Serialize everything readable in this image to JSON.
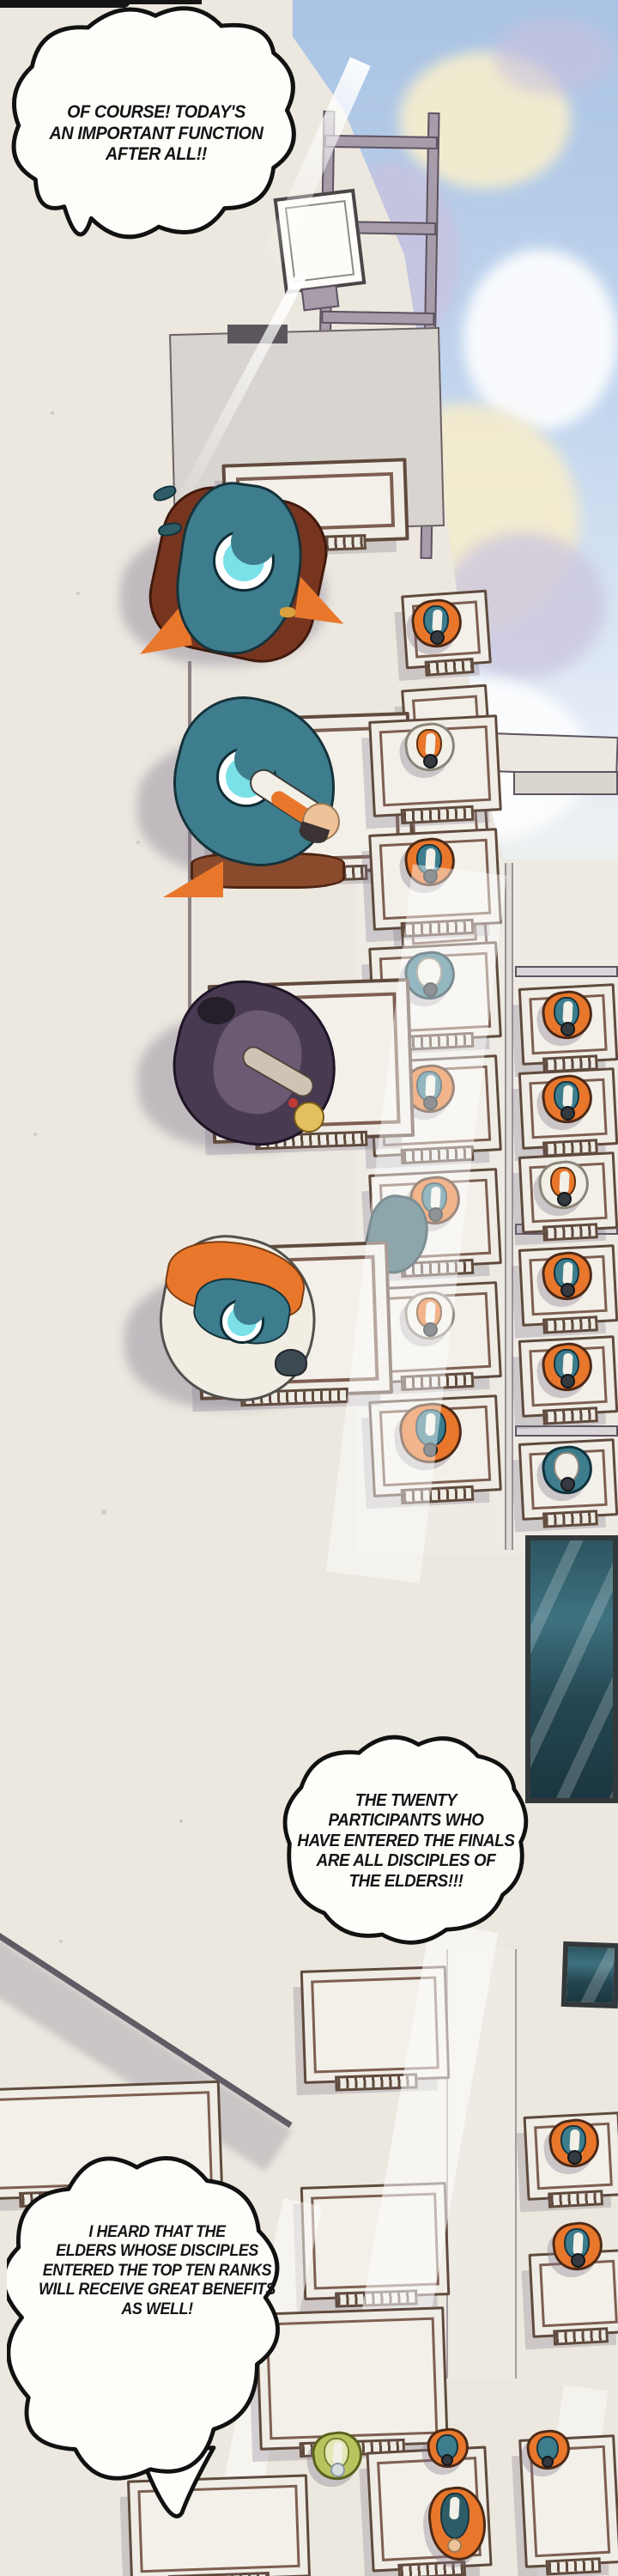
{
  "bubbles": [
    {
      "name": "shout-bubble-top-left",
      "lines": [
        "OF COURSE! TODAY'S",
        "AN IMPORTANT FUNCTION",
        "AFTER ALL!!"
      ]
    },
    {
      "name": "shout-bubble-middle-right",
      "lines": [
        "THE TWENTY",
        "PARTICIPANTS WHO",
        "HAVE ENTERED THE FINALS",
        "ARE ALL DISCIPLES OF",
        "THE ELDERS!!!"
      ]
    },
    {
      "name": "cloud-bubble-bottom-left",
      "lines": [
        "I HEARD THAT THE",
        "ELDERS WHOSE DISCIPLES",
        "ENTERED THE TOP TEN RANKS",
        "WILL RECEIVE GREAT BENEFITS",
        "AS WELL!"
      ]
    }
  ],
  "palette": {
    "paper": "#ece8df",
    "sky": "#a9c3e4",
    "cloud_cream": "#f4ecce",
    "cloud_lavender": "#c9c2de",
    "wall_gray": "#d8d4cf",
    "panel_gray": "#eeebe4",
    "shadow_gray": "#b3acb8",
    "frame_brown": "#7d5f51",
    "frame_dark": "#5f4a3d",
    "robe_teal": "#3d7d8d",
    "crescent_cyan": "#7be0e8",
    "accent_orange": "#e8772c",
    "cape_maroon": "#77351f",
    "robe_dark": "#483a50",
    "screen_dark": "#24424a",
    "ink": "#141414"
  }
}
